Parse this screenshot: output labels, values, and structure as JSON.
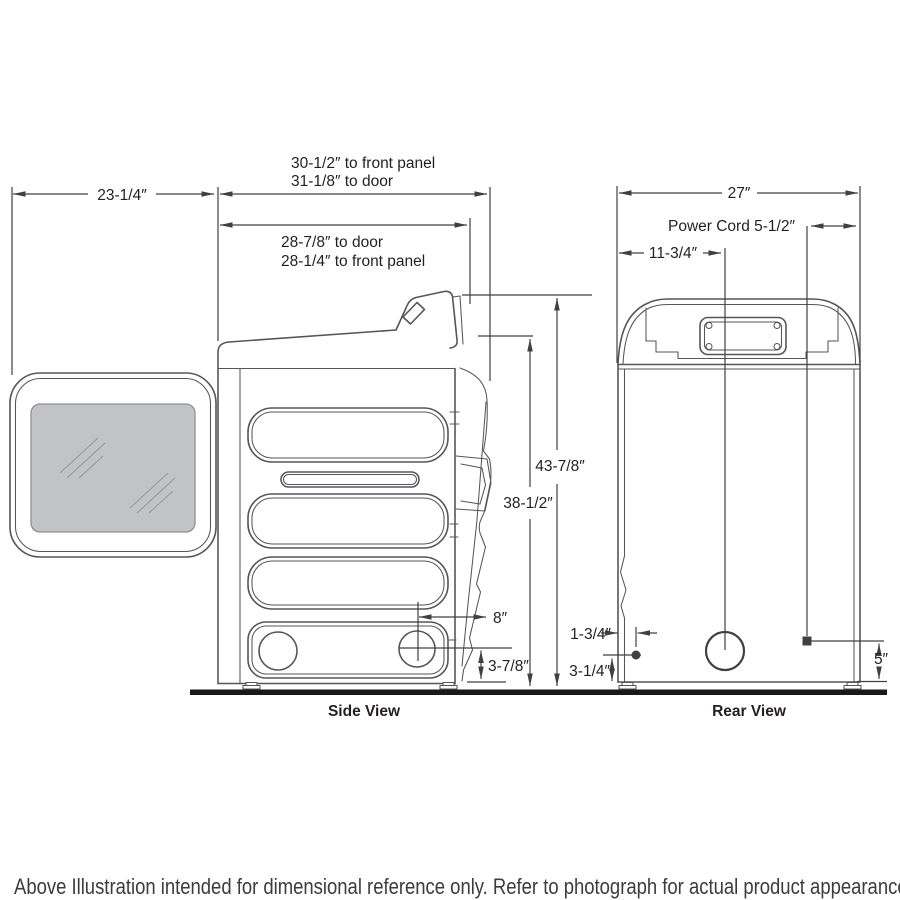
{
  "footnote": "Above Illustration intended for dimensional reference only. Refer to photograph for actual product appearance.",
  "side_view": {
    "caption": "Side View",
    "dims": {
      "door_open_depth": "23-1/4″",
      "depth_to_front_panel": "30-1/2″ to front panel",
      "depth_to_door": "31-1/8″ to door",
      "lower_depth_to_door": "28-7/8″ to door",
      "lower_depth_to_front_panel": "28-1/4″ to front panel",
      "overall_height": "43-7/8″",
      "cabinet_height": "38-1/2″",
      "exhaust_offset": "8″",
      "exhaust_height": "3-7/8″"
    }
  },
  "rear_view": {
    "caption": "Rear View",
    "dims": {
      "overall_width": "27″",
      "power_cord": "Power Cord 5-1/2″",
      "exhaust_from_left": "11-3/4″",
      "connection_offset": "1-3/4″",
      "connection_height": "3-1/4″",
      "cord_height": "5″"
    }
  },
  "colors": {
    "background": "#ffffff",
    "outline": "#55565a",
    "dimension": "#3f4043",
    "text": "#231f20",
    "glass_fill": "#c2c3c5",
    "floor": "#19191b"
  }
}
